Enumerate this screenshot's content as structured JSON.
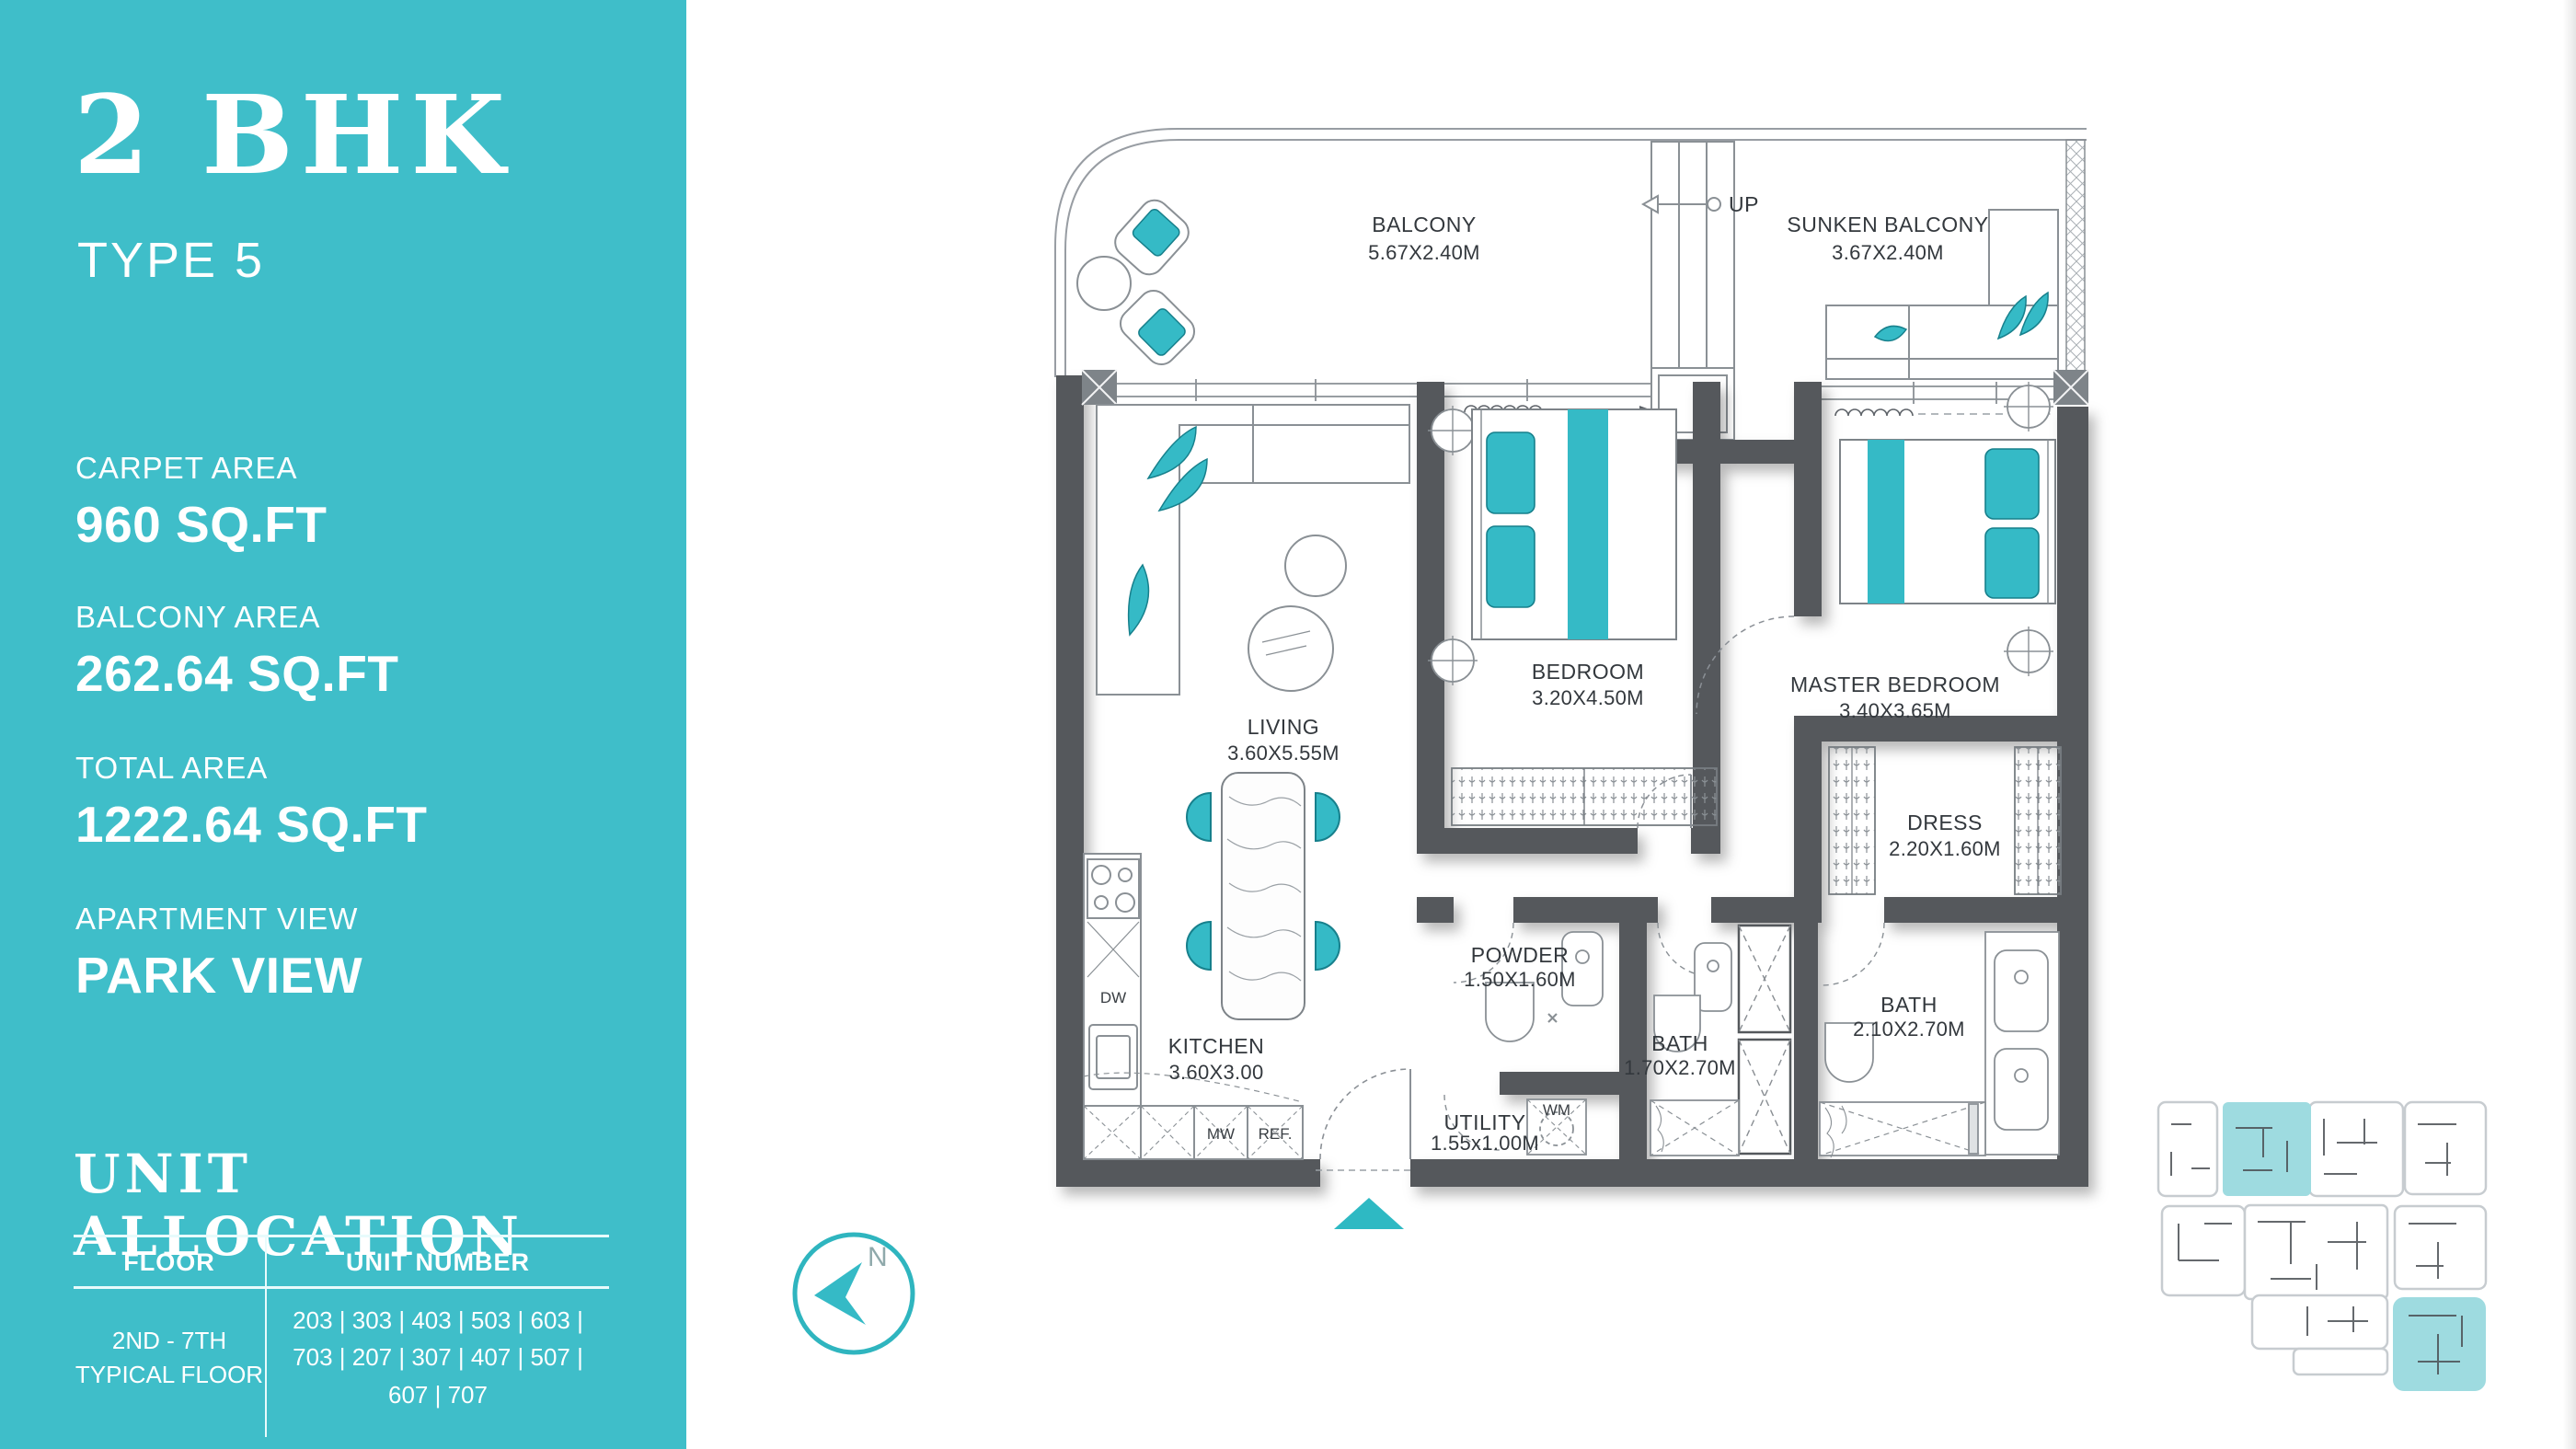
{
  "sidebar": {
    "title": "2 BHK",
    "subtitle": "TYPE 5",
    "accent_color": "#3FBEC9",
    "stats": [
      {
        "label": "CARPET AREA",
        "value": "960 SQ.FT"
      },
      {
        "label": "BALCONY AREA",
        "value": "262.64 SQ.FT"
      },
      {
        "label": "TOTAL AREA",
        "value": "1222.64 SQ.FT"
      },
      {
        "label": "APARTMENT VIEW",
        "value": "PARK VIEW"
      }
    ],
    "allocation": {
      "heading": "UNIT ALLOCATION",
      "col_floor": "FLOOR",
      "col_units": "UNIT NUMBER",
      "floor_line1": "2ND - 7TH",
      "floor_line2": "TYPICAL FLOOR",
      "units": "203 | 303 | 403 | 503 | 603 | 703 | 207 | 307 | 407 | 507 | 607 | 707"
    }
  },
  "plan": {
    "wall_color": "#54585C",
    "teal_color": "#35BAC6",
    "rooms": {
      "balcony": {
        "name": "BALCONY",
        "dims": "5.67X2.40M"
      },
      "sunken_balcony": {
        "name": "SUNKEN BALCONY",
        "dims": "3.67X2.40M"
      },
      "living": {
        "name": "LIVING",
        "dims": "3.60X5.55M"
      },
      "kitchen": {
        "name": "KITCHEN",
        "dims": "3.60X3.00"
      },
      "bedroom": {
        "name": "BEDROOM",
        "dims": "3.20X4.50M"
      },
      "master_bedroom": {
        "name": "MASTER BEDROOM",
        "dims": "3.40X3.65M"
      },
      "dress": {
        "name": "DRESS",
        "dims": "2.20X1.60M"
      },
      "powder": {
        "name": "POWDER",
        "dims": "1.50X1.60M"
      },
      "bath1": {
        "name": "BATH",
        "dims": "1.70X2.70M"
      },
      "utility": {
        "name": "UTILITY",
        "dims": "1.55x1.00M"
      },
      "bath2": {
        "name": "BATH",
        "dims": "2.10X2.70M"
      }
    },
    "labels": {
      "up": "UP",
      "dw": "DW",
      "mw": "MW",
      "ref": "REF.",
      "wm": "WM",
      "north": "N"
    },
    "keyplan_highlight": "#9EDBE0"
  }
}
